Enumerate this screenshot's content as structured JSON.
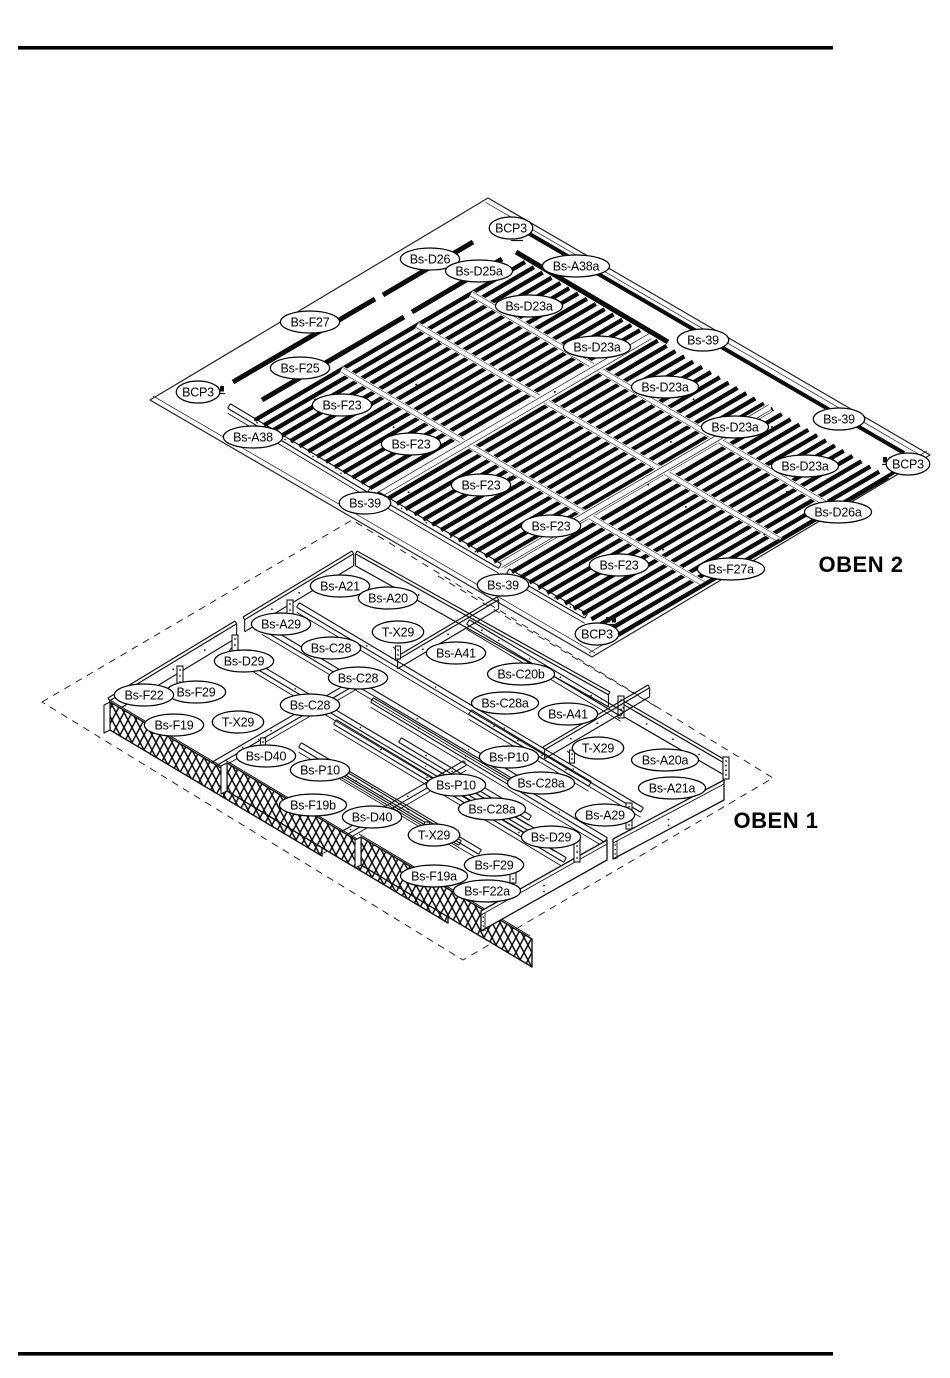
{
  "diagram": {
    "assemblies": [
      {
        "id": "oben2",
        "title": "OBEN 2",
        "title_pos": {
          "x": 861,
          "y": 572
        },
        "labels": [
          {
            "text": "BCP3",
            "x": 511,
            "y": 228
          },
          {
            "text": "Bs-D26",
            "x": 430,
            "y": 259
          },
          {
            "text": "Bs-D25a",
            "x": 479,
            "y": 271
          },
          {
            "text": "Bs-A38a",
            "x": 576,
            "y": 266
          },
          {
            "text": "Bs-D23a",
            "x": 529,
            "y": 306
          },
          {
            "text": "Bs-F27",
            "x": 310,
            "y": 322
          },
          {
            "text": "Bs-D23a",
            "x": 597,
            "y": 347
          },
          {
            "text": "Bs-39",
            "x": 703,
            "y": 340
          },
          {
            "text": "Bs-F25",
            "x": 300,
            "y": 368
          },
          {
            "text": "Bs-D23a",
            "x": 665,
            "y": 387
          },
          {
            "text": "BCP3",
            "x": 198,
            "y": 392
          },
          {
            "text": "Bs-F23",
            "x": 342,
            "y": 405
          },
          {
            "text": "Bs-39",
            "x": 839,
            "y": 419
          },
          {
            "text": "Bs-D23a",
            "x": 735,
            "y": 427
          },
          {
            "text": "Bs-A38",
            "x": 253,
            "y": 437
          },
          {
            "text": "Bs-F23",
            "x": 411,
            "y": 444
          },
          {
            "text": "BCP3",
            "x": 908,
            "y": 464
          },
          {
            "text": "Bs-D23a",
            "x": 805,
            "y": 466
          },
          {
            "text": "Bs-F23",
            "x": 481,
            "y": 485
          },
          {
            "text": "Bs-39",
            "x": 365,
            "y": 503
          },
          {
            "text": "Bs-D26a",
            "x": 838,
            "y": 512
          },
          {
            "text": "Bs-F23",
            "x": 551,
            "y": 526
          },
          {
            "text": "Bs-F23",
            "x": 619,
            "y": 565
          },
          {
            "text": "Bs-F27a",
            "x": 731,
            "y": 569
          },
          {
            "text": "Bs-39",
            "x": 503,
            "y": 585
          },
          {
            "text": "BCP3",
            "x": 597,
            "y": 634
          }
        ]
      },
      {
        "id": "oben1",
        "title": "OBEN 1",
        "title_pos": {
          "x": 776,
          "y": 828
        },
        "labels": [
          {
            "text": "Bs-A21",
            "x": 340,
            "y": 586
          },
          {
            "text": "Bs-A20",
            "x": 388,
            "y": 598
          },
          {
            "text": "Bs-A29",
            "x": 281,
            "y": 624
          },
          {
            "text": "T-X29",
            "x": 398,
            "y": 632
          },
          {
            "text": "Bs-C28",
            "x": 331,
            "y": 648
          },
          {
            "text": "Bs-A41",
            "x": 456,
            "y": 653
          },
          {
            "text": "Bs-D29",
            "x": 244,
            "y": 661
          },
          {
            "text": "Bs-C20b",
            "x": 521,
            "y": 674
          },
          {
            "text": "Bs-C28",
            "x": 358,
            "y": 678
          },
          {
            "text": "Bs-F29",
            "x": 196,
            "y": 692
          },
          {
            "text": "Bs-F22",
            "x": 144,
            "y": 695
          },
          {
            "text": "Bs-C28a",
            "x": 505,
            "y": 703
          },
          {
            "text": "Bs-C28",
            "x": 310,
            "y": 705
          },
          {
            "text": "Bs-A41",
            "x": 568,
            "y": 714
          },
          {
            "text": "T-X29",
            "x": 238,
            "y": 722
          },
          {
            "text": "Bs-F19",
            "x": 174,
            "y": 725
          },
          {
            "text": "T-X29",
            "x": 598,
            "y": 748
          },
          {
            "text": "Bs-D40",
            "x": 266,
            "y": 756
          },
          {
            "text": "Bs-P10",
            "x": 509,
            "y": 757
          },
          {
            "text": "Bs-A20a",
            "x": 665,
            "y": 760
          },
          {
            "text": "Bs-P10",
            "x": 320,
            "y": 770
          },
          {
            "text": "Bs-C28a",
            "x": 541,
            "y": 783
          },
          {
            "text": "Bs-P10",
            "x": 456,
            "y": 785
          },
          {
            "text": "Bs-A21a",
            "x": 672,
            "y": 788
          },
          {
            "text": "Bs-F19b",
            "x": 313,
            "y": 805
          },
          {
            "text": "Bs-C28a",
            "x": 492,
            "y": 809
          },
          {
            "text": "Bs-A29",
            "x": 605,
            "y": 815
          },
          {
            "text": "Bs-D40",
            "x": 372,
            "y": 817
          },
          {
            "text": "T-X29",
            "x": 434,
            "y": 835
          },
          {
            "text": "Bs-D29",
            "x": 551,
            "y": 837
          },
          {
            "text": "Bs-F29",
            "x": 494,
            "y": 865
          },
          {
            "text": "Bs-F19a",
            "x": 434,
            "y": 876
          },
          {
            "text": "Bs-F22a",
            "x": 487,
            "y": 891
          }
        ]
      }
    ]
  }
}
